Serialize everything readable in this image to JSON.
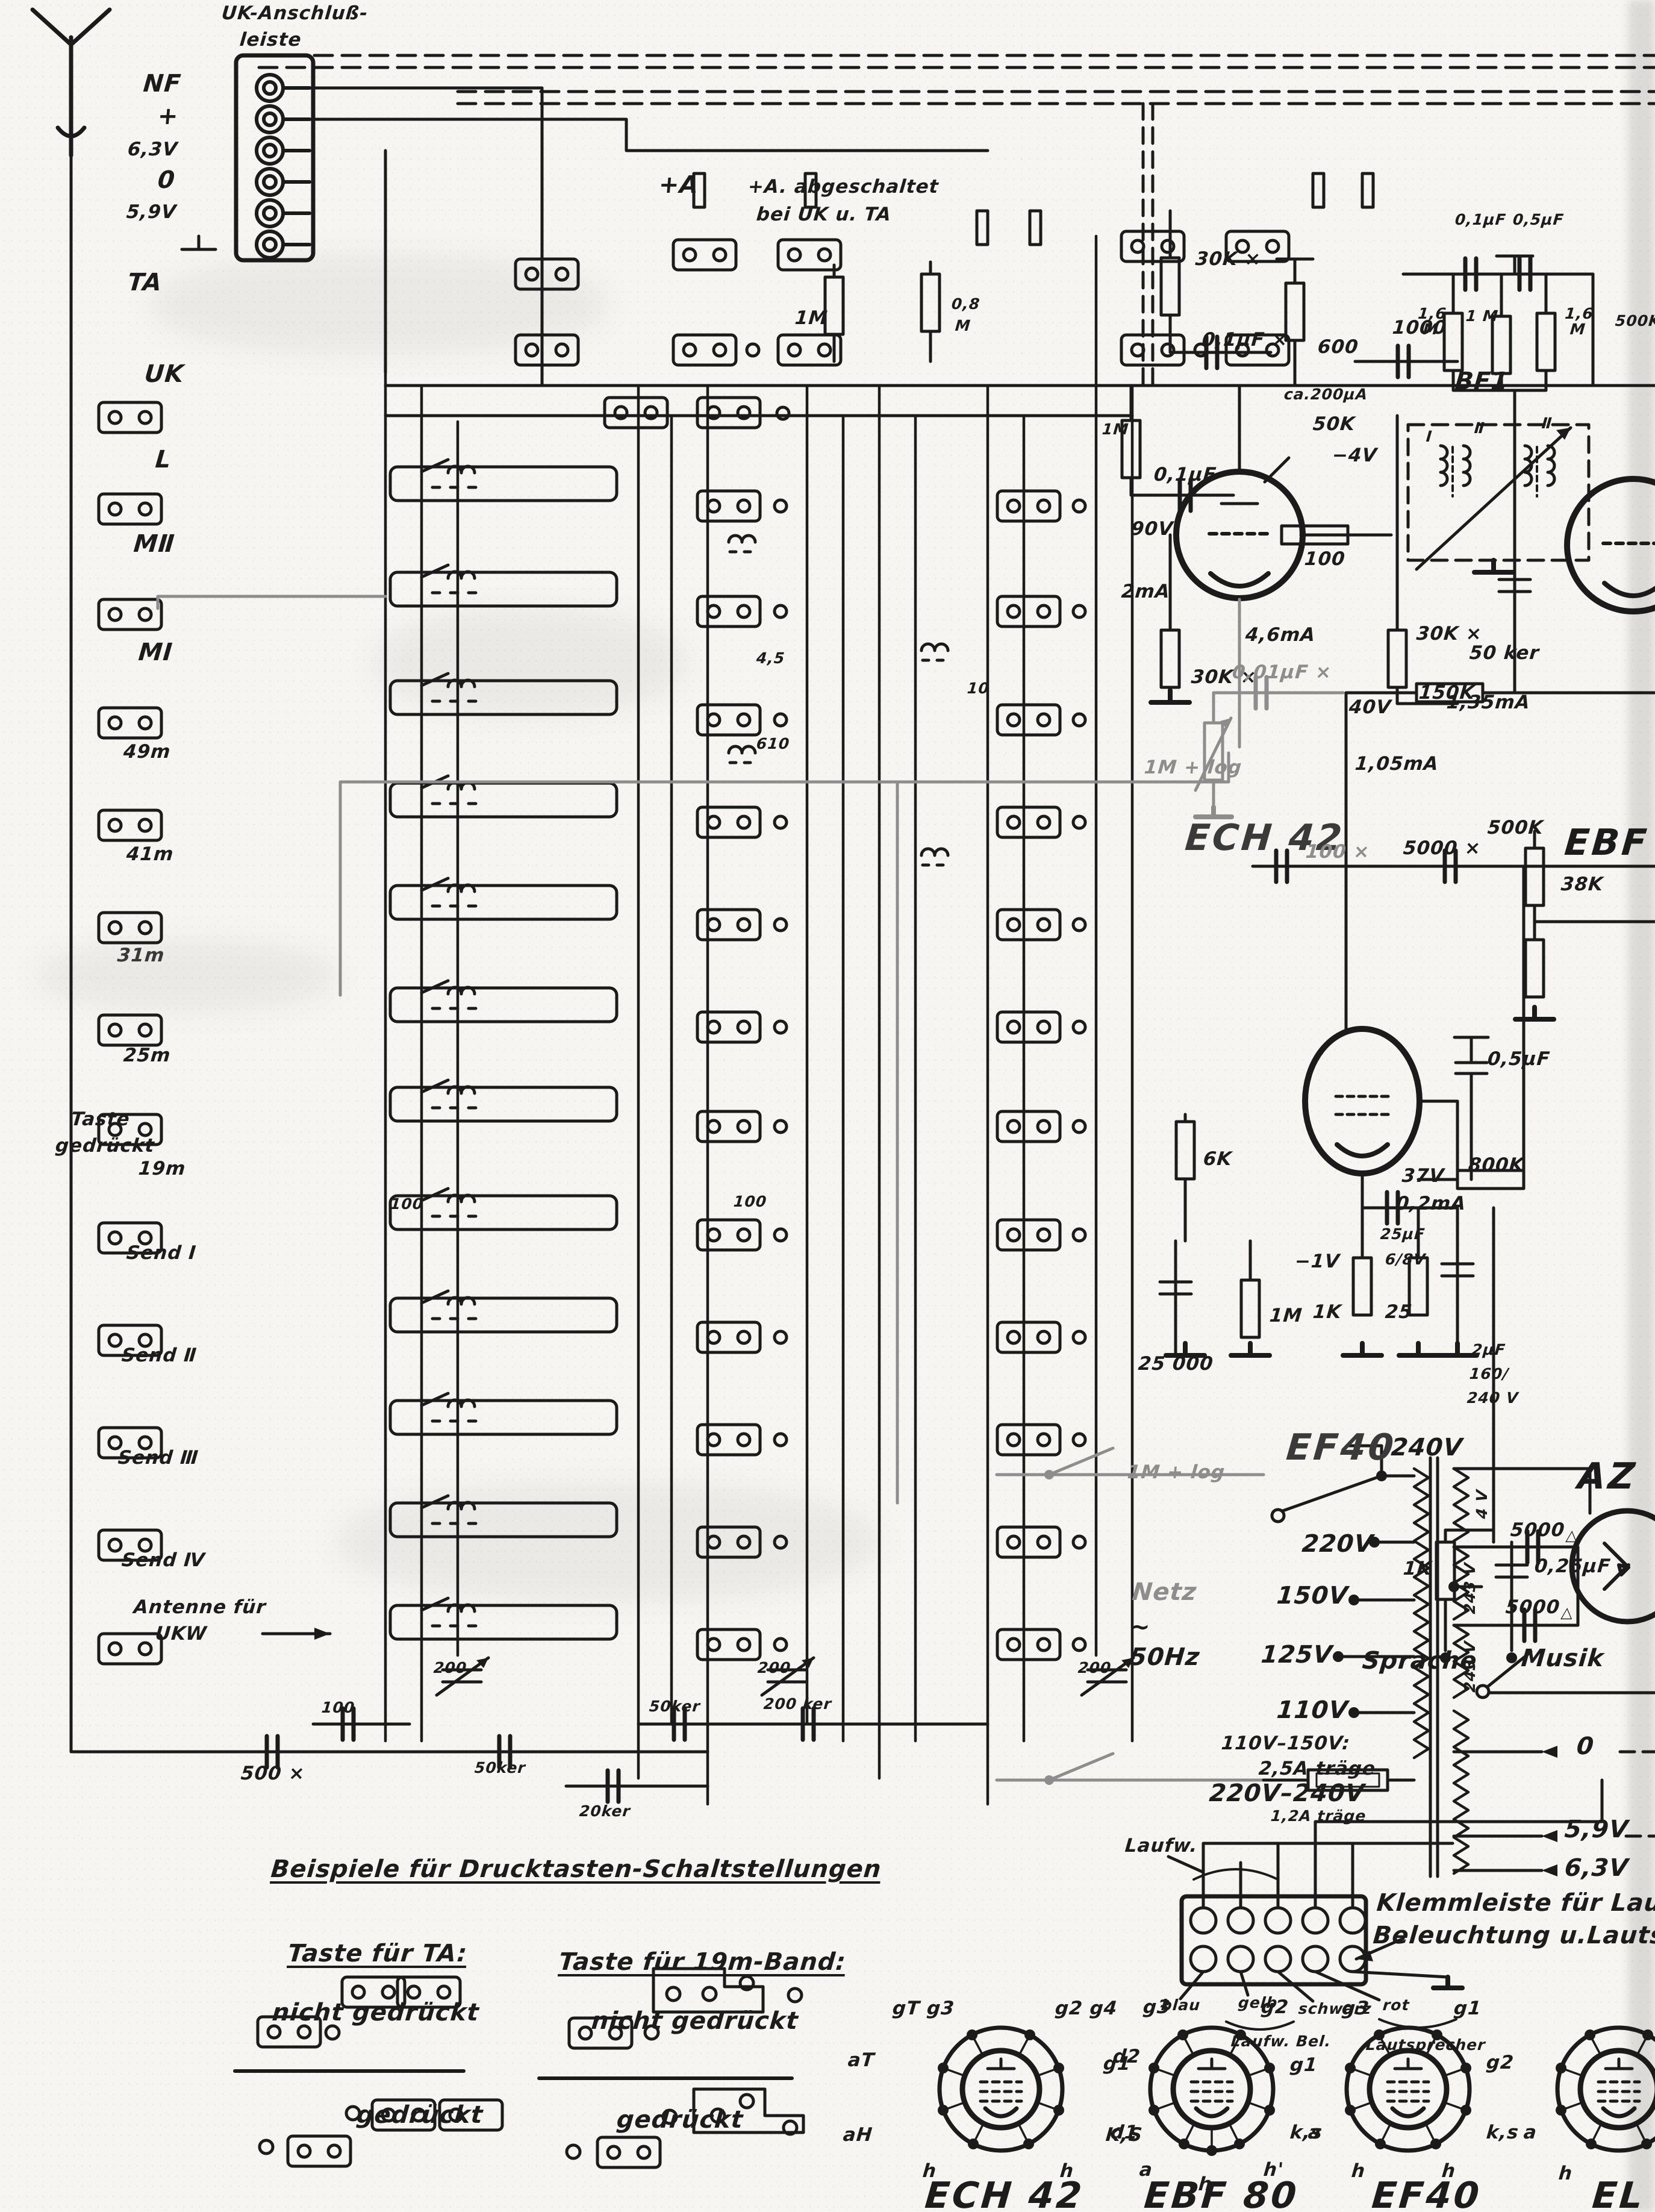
{
  "page": {
    "bg": "#f6f5f1",
    "ink": "#1b1b1b",
    "pencil": "#8d8d8d"
  },
  "strip": {
    "title1": "UK-Anschluß-",
    "title2": "leiste",
    "terminals": [
      "NF",
      "+",
      "6,3V",
      "0",
      "5,9V"
    ],
    "ta": "TA"
  },
  "bands": {
    "items": [
      "UK",
      "L",
      "MⅡ",
      "MⅠ",
      "49m",
      "41m",
      "31m",
      "25m",
      "19m",
      "Send Ⅰ",
      "Send Ⅱ",
      "Send Ⅲ",
      "Send Ⅳ"
    ],
    "taste1": "Taste",
    "taste2": "gedrückt",
    "ant1": "Antenne für",
    "ant2": "UKW"
  },
  "top": {
    "a1": "+A",
    "note1": "+A. abgeschaltet",
    "note2": "bei UK u. TA",
    "r1m": "1M",
    "r08a": "0,8",
    "r08b": "M"
  },
  "matrix": {
    "c45": "4,5",
    "c10": "10",
    "c610": "610",
    "c100a": "100",
    "c100b": "100"
  },
  "caps_row": {
    "c200a": "200",
    "c200b": "200",
    "c200c": "200",
    "c100": "100",
    "c500": "500 ×",
    "c50a": "50ker",
    "c50b": "50ker",
    "c200ker": "200 ker",
    "c20ker": "20ker"
  },
  "ech42": {
    "name": "ECH 42",
    "r30k_a": "30K ×",
    "c01x": "0,1µF ×",
    "r600": "600",
    "ma200": "ca.200µA",
    "r50k": "50K",
    "vm4": "−4V",
    "r1m": "1M",
    "c01": "0,1µF",
    "v90": "90V",
    "ma2": "2mA",
    "r100": "100",
    "r30k_b": "30K ×",
    "ma46": "4,6mA",
    "r30k_c": "30K ×",
    "ma135": "1,35mA",
    "c1000": "1000",
    "bf1": "BF1",
    "w1": "Ⅰ",
    "w2": "Ⅱ",
    "w3": "Ⅱ"
  },
  "ebf": {
    "name": "EBF",
    "c1": "0,1µF",
    "c2": "0,5µF",
    "r1": "1,6 M",
    "r2": "1 M",
    "r3": "1,6 M",
    "r4": "500K",
    "c50": "50 ker",
    "r500k": "500K",
    "r38k": "38K"
  },
  "ef40": {
    "name": "EF40",
    "c001": "0,01µF ×",
    "pot1": "1M + log",
    "pot2": "1M + log",
    "v40": "40V",
    "r150k": "150K",
    "ma105": "1,05mA",
    "c100x": "100 ×",
    "c5000x": "5000 ×",
    "r800k": "800K",
    "v37": "37V",
    "ma02": "0,2mA",
    "c05": "0,5µF",
    "r6k": "6K",
    "c25000": "25 000",
    "r1m": "1M",
    "vm1": "−1V",
    "r1k": "1K",
    "c25a": "25µF",
    "c25b": "6/8V",
    "c25": "25",
    "c2a": "2µF",
    "c2b": "160/",
    "c2c": "240 V",
    "r1kb": "1K",
    "c025": "0,25µF",
    "sprache": "Sprache",
    "musik": "Musik"
  },
  "power": {
    "netz": "Netz",
    "tilde": "~",
    "hz": "50Hz",
    "taps": [
      "240V",
      "220V",
      "150V",
      "125V",
      "110V"
    ],
    "fuse1": "110V–150V:",
    "fuse2": "2,5A träge",
    "fuse3": "220V–240V",
    "fuse4": "1,2A träge",
    "sec": [
      "4 V",
      "243 V",
      "243 V"
    ],
    "c5000a": "5000",
    "c5000b": "5000",
    "out": [
      "0",
      "5,9V",
      "6,3V"
    ],
    "az": "AZ",
    "laufw": "Laufw."
  },
  "klemm": {
    "cap1": "Klemmleiste für Laufwer",
    "cap2": "Beleuchtung u.Lautsprech",
    "colors": [
      "blau",
      "gelb",
      "schwarz",
      "rot"
    ],
    "b1": "Laufw. Bel.",
    "b2": "Lautsprecher"
  },
  "legend": {
    "title": "Beispiele für Drucktasten-Schaltstellungen",
    "c1": "Taste für TA:",
    "c2": "Taste für 19m-Band:",
    "nicht": "nicht gedrückt",
    "ged": "gedrückt"
  },
  "pinouts": {
    "ech42": {
      "name": "ECH 42",
      "pins": [
        "gT g3",
        "g2 g4",
        "aT",
        "g1",
        "aH",
        "K,S",
        "h",
        "h"
      ]
    },
    "ebf80": {
      "name": "EBF 80",
      "pins": [
        "g3",
        "g2",
        "d2",
        "g1",
        "d1",
        "k,s",
        "a",
        "h",
        "h'"
      ]
    },
    "ef40": {
      "name": "EF40",
      "pins": [
        "g3",
        "g1",
        "g2",
        "a",
        "k,s",
        "h",
        "h"
      ]
    },
    "el": {
      "name": "EL",
      "pins": [
        "a",
        "h"
      ]
    }
  }
}
